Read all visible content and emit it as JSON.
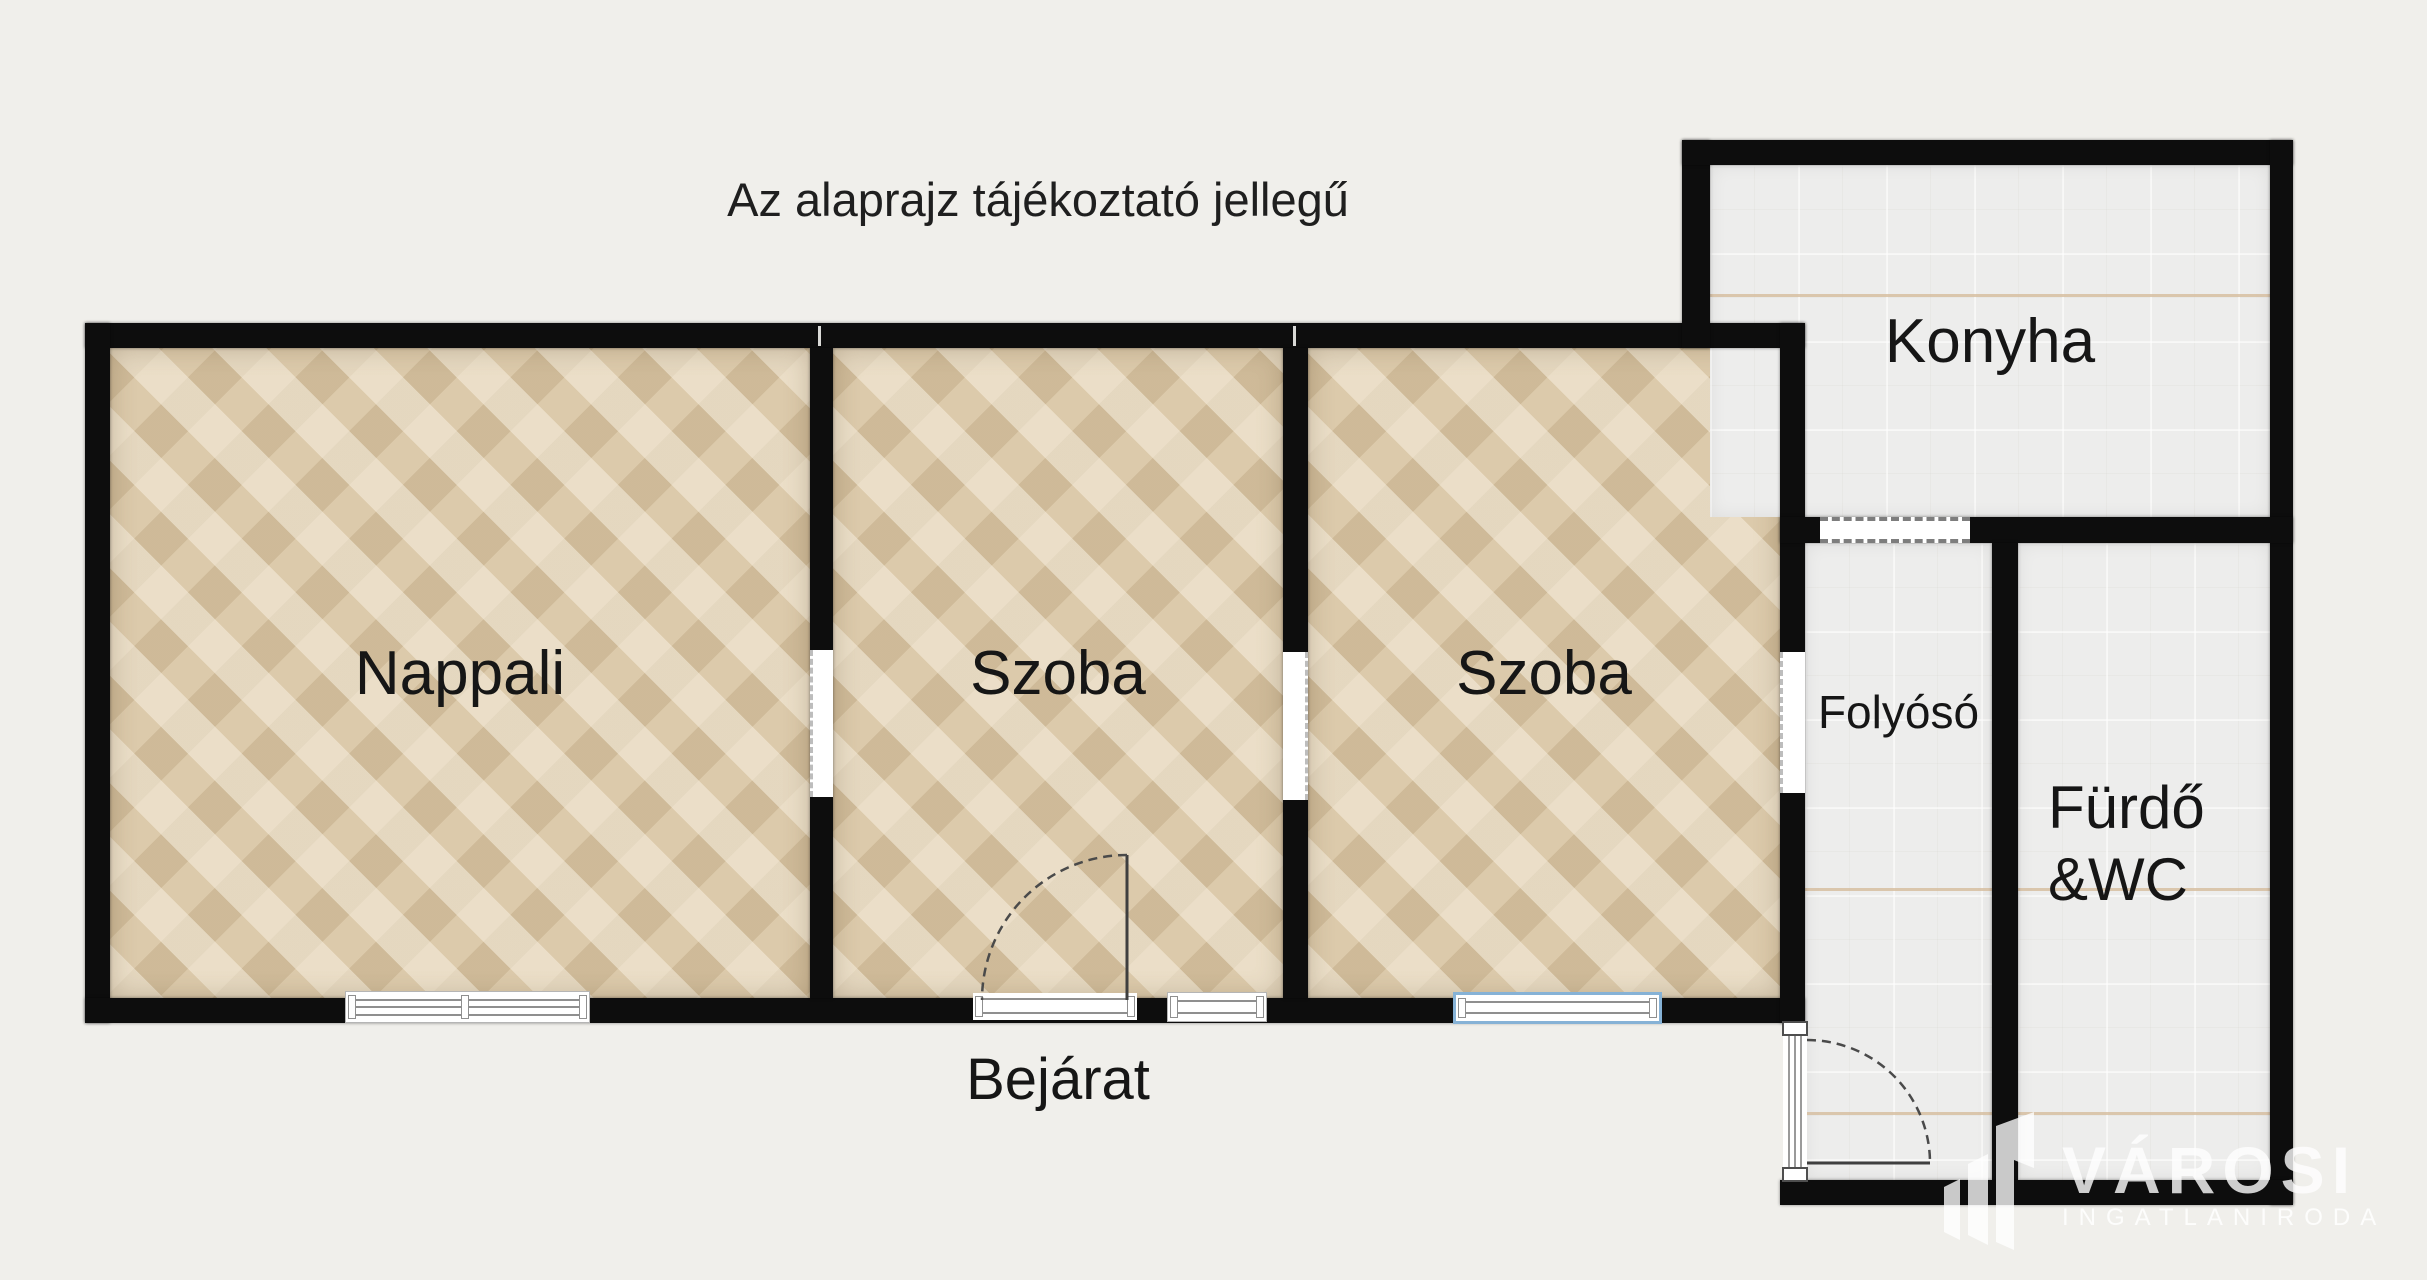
{
  "note": "Az alaprajz tájékoztató jellegű",
  "rooms": {
    "nappali": "Nappali",
    "szoba1": "Szoba",
    "szoba2": "Szoba",
    "konyha": "Konyha",
    "folyoso": "Folyósó",
    "furdo_line1": "Fürdő",
    "furdo_line2": "&WC"
  },
  "entrance": "Bejárat",
  "logo": {
    "brand": "VÁROSI",
    "subtitle": "INGATLANIRODA"
  },
  "colors": {
    "background": "#f0efeb",
    "wall": "#0d0d0d",
    "parquet": "#dccaab",
    "tile": "#ededec",
    "window_accent": "#86b2d6",
    "door_arc": "#4a4a4a",
    "logo": "#ffffff"
  }
}
